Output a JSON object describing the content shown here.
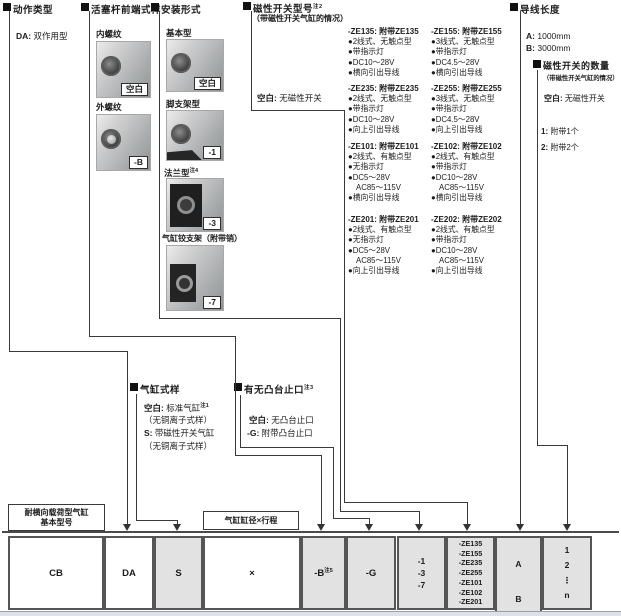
{
  "sections": {
    "action": {
      "title": "动作类型",
      "item": {
        "code": "DA:",
        "label": "双作用型"
      }
    },
    "rod_end": {
      "title": "活塞杆前端式样",
      "options": [
        {
          "label": "内螺纹",
          "code": "空白"
        },
        {
          "label": "外螺纹",
          "code": "-B"
        }
      ]
    },
    "mounting": {
      "title": "安装形式",
      "options": [
        {
          "label": "基本型",
          "sup": "",
          "code": "空白"
        },
        {
          "label": "脚支架型",
          "sup": "",
          "code": "-1"
        },
        {
          "label": "法兰型",
          "sup": "注4",
          "code": "-3"
        },
        {
          "label": "气缸铰支架（附带销）",
          "sup": "",
          "code": "-7"
        }
      ]
    },
    "switch_model": {
      "title": "磁性开关型号",
      "sup": "注2",
      "subtitle": "（带磁性开关气缸的情况）",
      "none": {
        "code": "空白:",
        "label": "无磁性开关"
      },
      "col1": [
        {
          "code": "-ZE135:",
          "name": "附带ZE135",
          "lines": [
            "●2线式、无触点型",
            "●带指示灯",
            "●DC10～28V",
            "●横向引出导线"
          ]
        },
        {
          "code": "-ZE235:",
          "name": "附带ZE235",
          "lines": [
            "●2线式、无触点型",
            "●带指示灯",
            "●DC10～28V",
            "●向上引出导线"
          ]
        },
        {
          "code": "-ZE101:",
          "name": "附带ZE101",
          "lines": [
            "●2线式、有触点型",
            "●无指示灯",
            "●DC5～28V",
            "AC85～115V",
            "●横向引出导线"
          ]
        },
        {
          "code": "-ZE201:",
          "name": "附带ZE201",
          "lines": [
            "●2线式、有触点型",
            "●无指示灯",
            "●DC5～28V",
            "AC85～115V",
            "●向上引出导线"
          ]
        }
      ],
      "col2": [
        {
          "code": "-ZE155:",
          "name": "附带ZE155",
          "lines": [
            "●3线式、无触点型",
            "●带指示灯",
            "●DC4.5～28V",
            "●横向引出导线"
          ]
        },
        {
          "code": "-ZE255:",
          "name": "附带ZE255",
          "lines": [
            "●3线式、无触点型",
            "●带指示灯",
            "●DC4.5～28V",
            "●向上引出导线"
          ]
        },
        {
          "code": "-ZE102:",
          "name": "附带ZE102",
          "lines": [
            "●2线式、有触点型",
            "●带指示灯",
            "●DC10～28V",
            "AC85～115V",
            "●横向引出导线"
          ]
        },
        {
          "code": "-ZE202:",
          "name": "附带ZE202",
          "lines": [
            "●2线式、有触点型",
            "●带指示灯",
            "●DC10～28V",
            "AC85～115V",
            "●向上引出导线"
          ]
        }
      ]
    },
    "cylinder_spec": {
      "title": "气缸式样",
      "line1_code": "空白:",
      "line1": "标准气缸",
      "line1_sup": "注1",
      "line2": "（无铜离子式样）",
      "line3_code": "S:",
      "line3": "带磁性开关气缸",
      "line4": "（无铜离子式样）"
    },
    "boss": {
      "title": "有无凸台止口",
      "sup": "注3",
      "opt1_code": "空白:",
      "opt1": "无凸台止口",
      "opt2_code": "-G:",
      "opt2": "附带凸台止口"
    },
    "lead_length": {
      "title": "导线长度",
      "options": [
        {
          "code": "A:",
          "label": "1000mm"
        },
        {
          "code": "B:",
          "label": "3000mm"
        }
      ]
    },
    "switch_qty": {
      "title": "磁性开关的数量",
      "subtitle": "（带磁性开关气缸的情况）",
      "none": {
        "code": "空白:",
        "label": "无磁性开关"
      },
      "options": [
        {
          "code": "1:",
          "label": "附带1个"
        },
        {
          "code": "2:",
          "label": "附带2个"
        }
      ]
    }
  },
  "bottom": {
    "base_label_line1": "耐横向载荷型气缸",
    "base_label_line2": "基本型号",
    "bore_label": "气缸缸径×行程",
    "boxes": {
      "cb": "CB",
      "da": "DA",
      "s": "S",
      "bore": "×",
      "b": "-B",
      "b_sup": "注5",
      "g": "-G",
      "mount_codes": [
        "-1",
        "-3",
        "-7"
      ],
      "switch_codes": [
        "-ZE135",
        "-ZE155",
        "-ZE235",
        "-ZE255",
        "-ZE101",
        "-ZE102",
        "-ZE201"
      ],
      "lead_codes": [
        "A",
        "B"
      ],
      "qty_codes": [
        "1",
        "2",
        "⋮",
        "n"
      ]
    }
  }
}
